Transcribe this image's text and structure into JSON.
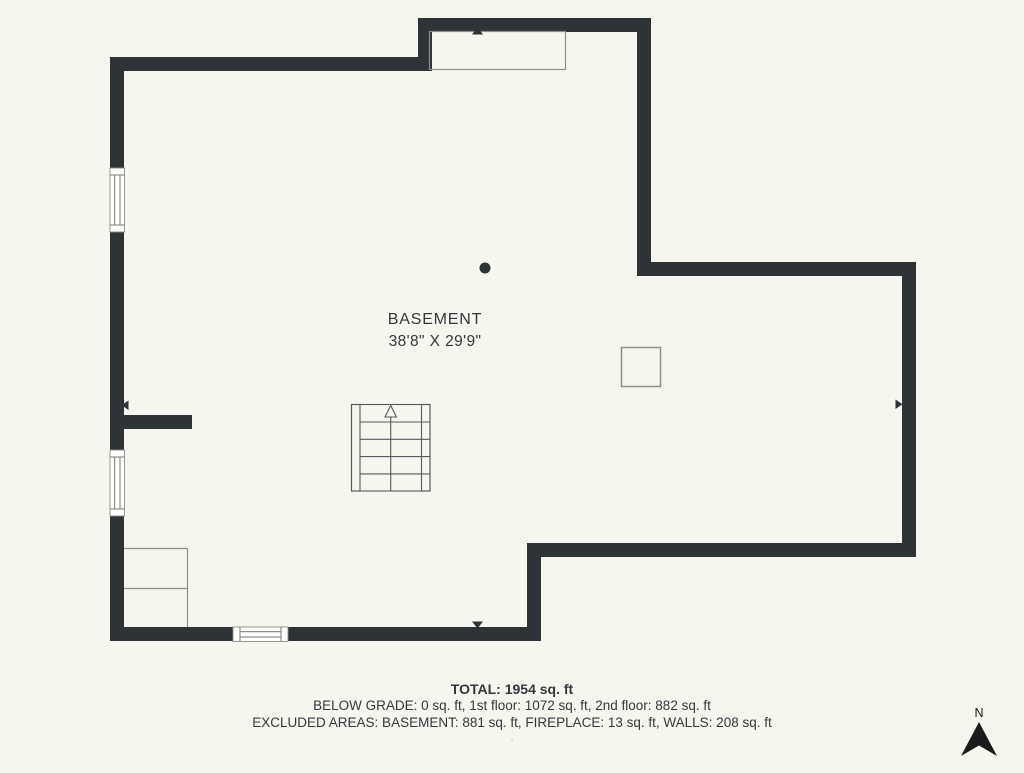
{
  "plan": {
    "room_label": "BASEMENT",
    "room_dimensions": "38'8\" X 29'9\""
  },
  "summary": {
    "total": "TOTAL: 1954 sq. ft",
    "below_grade": "BELOW GRADE: 0 sq. ft, 1st floor: 1072 sq. ft, 2nd floor: 882 sq. ft",
    "excluded": "EXCLUDED AREAS: BASEMENT: 881 sq. ft, FIREPLACE: 13 sq. ft, WALLS: 208 sq. ft",
    "footnote": "."
  },
  "compass": {
    "north_label": "N"
  },
  "colors": {
    "background": "#f6f6ef",
    "wall": "#2e3338",
    "thin_line": "#8e8e88",
    "stair_line": "#55595e",
    "window_fill": "#ffffff",
    "text": "#33383e",
    "north": "#1a1b1d"
  }
}
